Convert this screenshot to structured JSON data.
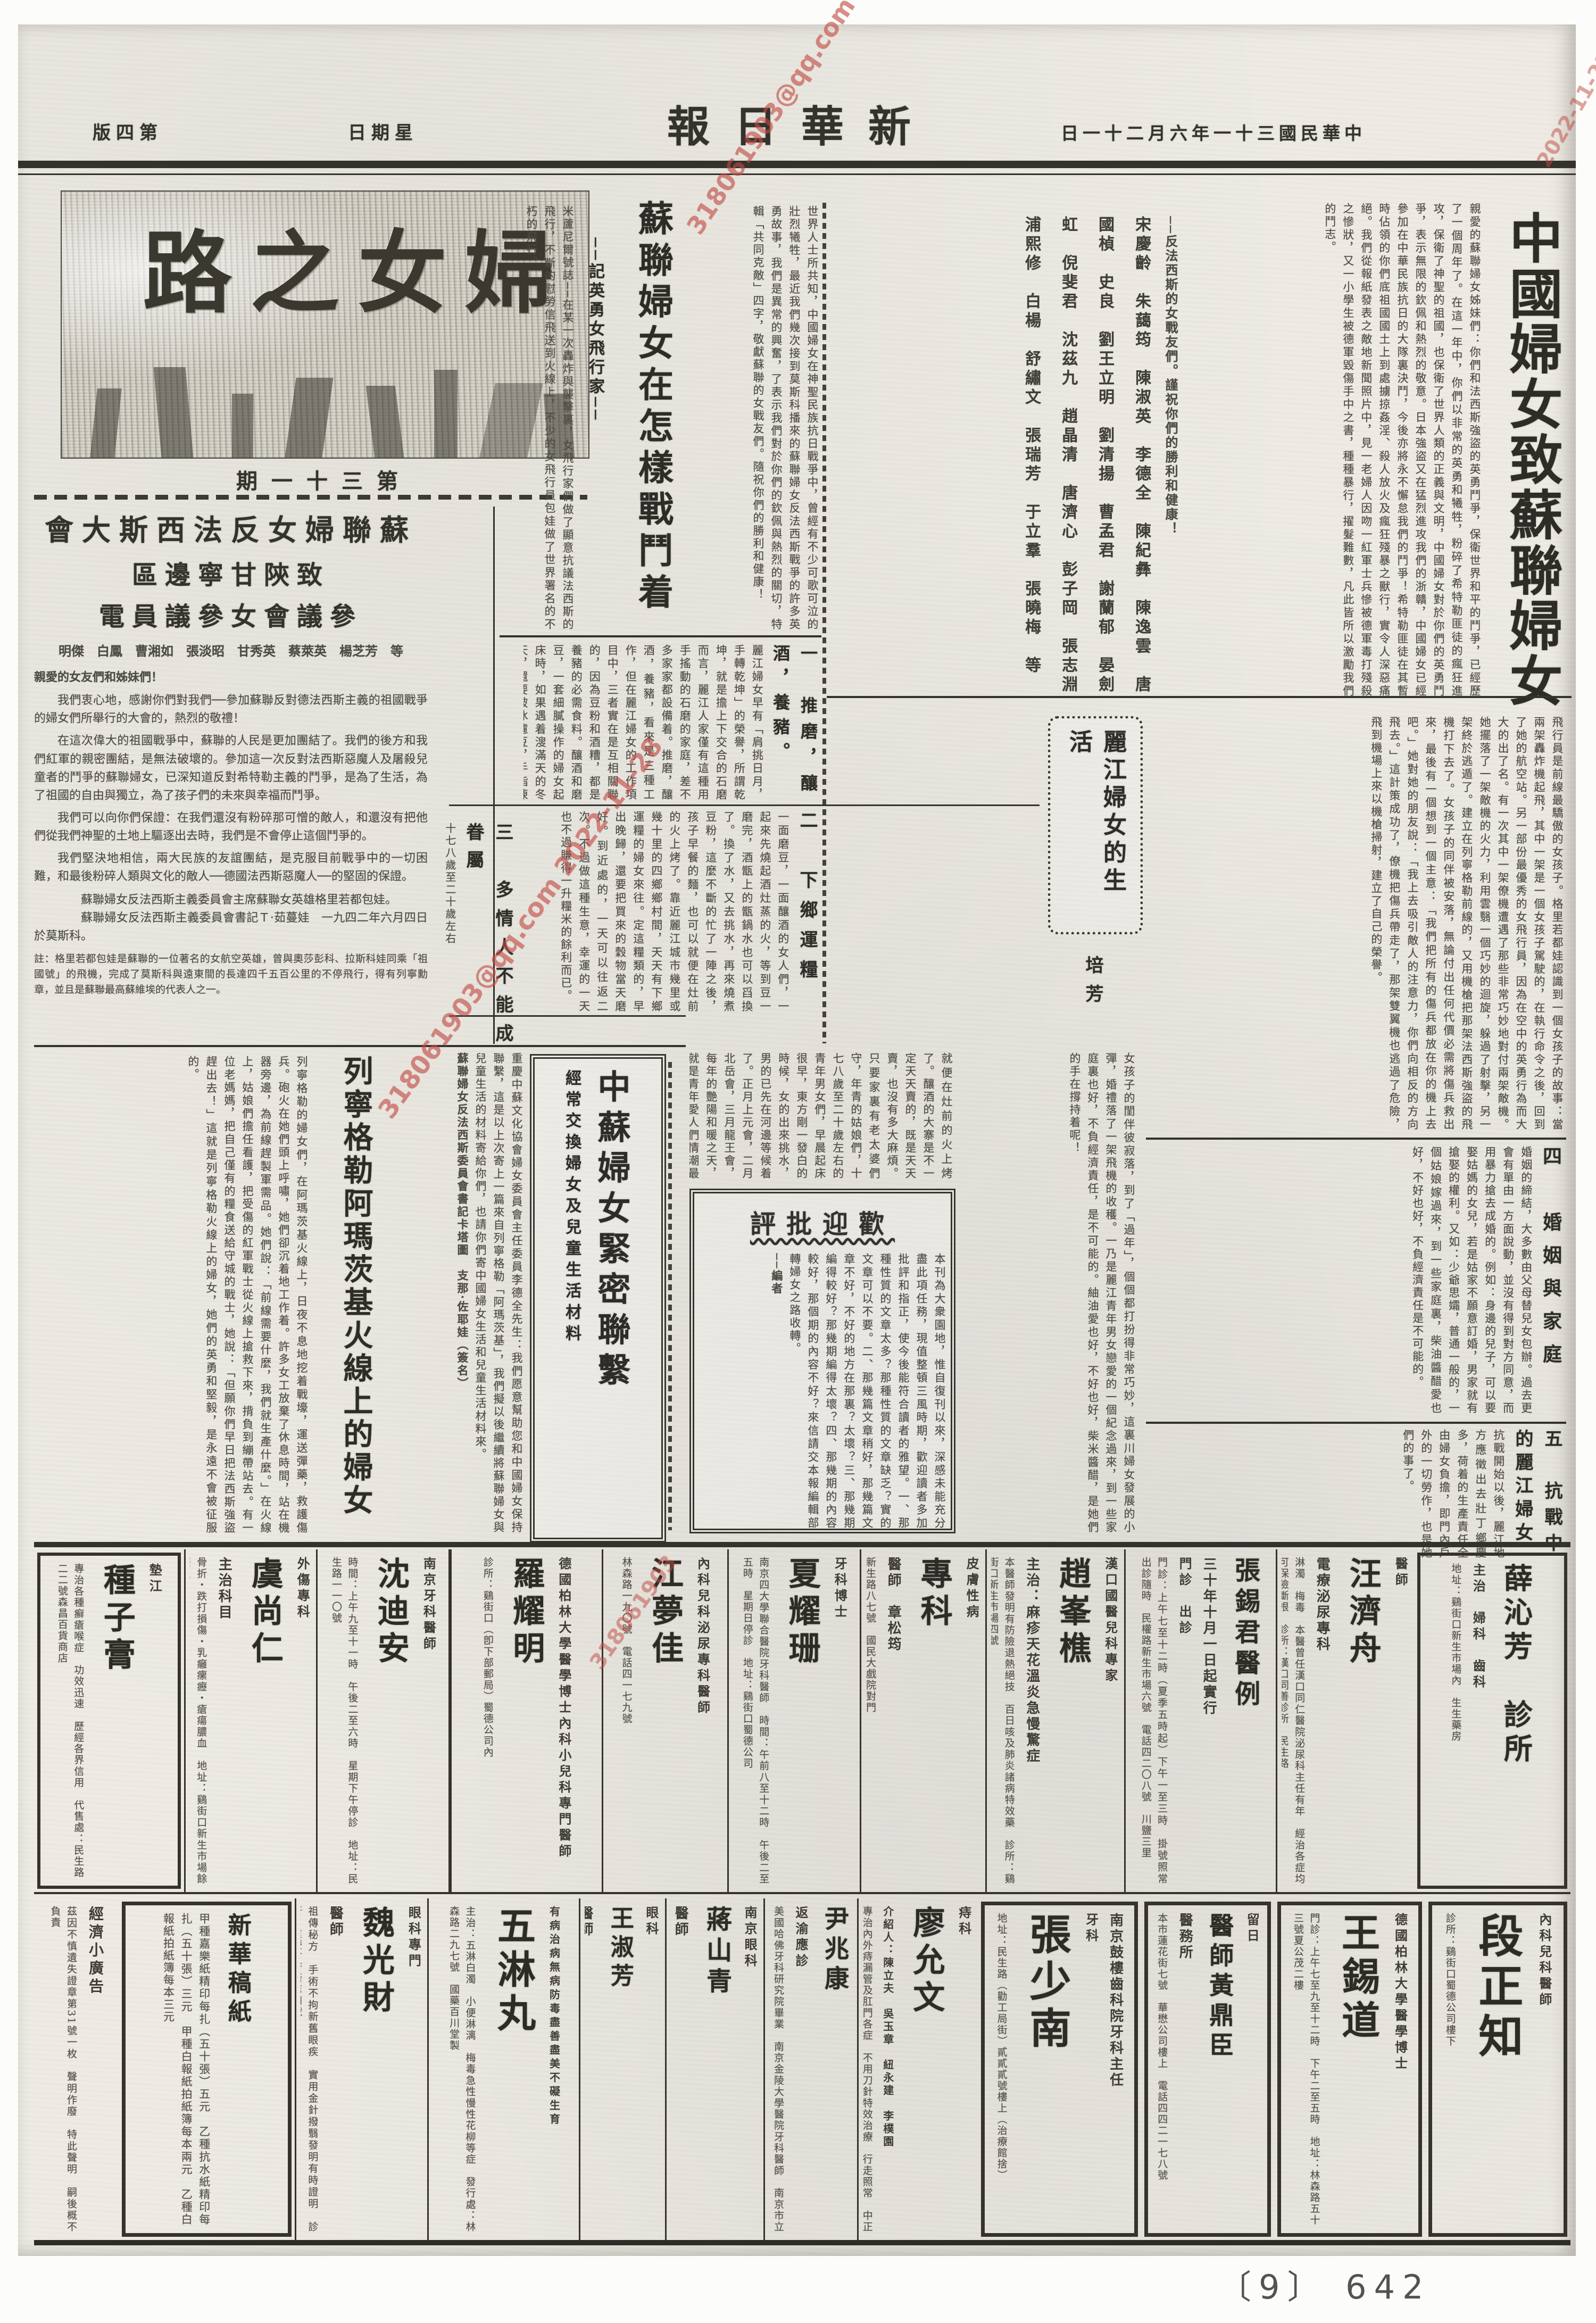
{
  "header": {
    "date": "中華民國三十一年六月二十一日",
    "paper_name": "新華日報",
    "weekday": "星期日",
    "edition": "第四版"
  },
  "masthead": {
    "title": "婦女之路",
    "issue": "第三十一期"
  },
  "watermark": {
    "text": "318061903@qq.com 2022-11-28",
    "short": "318061903",
    "date_only": "2022-11-28",
    "color": "#c24a42"
  },
  "letter_right": {
    "title": "中國婦女致蘇聯婦女書",
    "body": "親愛的蘇聯婦女姊妹們：你們和法西斯強盜的英勇鬥爭，保衛世界和平的鬥爭，已經歷了一個周年了。在這一年中，你們以非常的英勇和犧牲，粉碎了希特勒匪徒的瘋狂進攻，保衛了神聖的祖國，也保衛了世界人類的正義與文明，中國婦女對於你們的英勇鬥爭，表示無限的欽佩和熱烈的敬意。日本強盜又在猛烈進攻我們的浙贛，中國婦女已經參加在中華民族抗日的大隊裏決鬥，今後亦將永不懈怠我們的鬥爭！希特勒匪徒在其暫時佔領的你們底祖國國土上到處擄掠姦淫、殺人放火及瘋狂殘暴之獸行，實令人深惡痛絕。我們從報紙發表之敵地新聞照片中，見一老婦人因吻一紅軍士兵慘被德軍毒打殘殺之慘狀，又一小學生被德軍毀傷手中之書，種種暴行，擢髮難數，凡此皆所以激勵我們的鬥志。",
    "closing": "──反法西斯的女戰友們。謹祝你們的勝利和健康！",
    "signatories": "宋慶齡　朱藹筠　陳淑英　李德全　陳紀彝　陳逸雲　唐國楨　史良　劉王立明　劉清揚　曹孟君　謝蘭郁　晏劍虹　倪斐君　沈茲九　趙晶清　唐濟心　彭子岡　張志淵　浦熙修　白楊　舒繡文　張瑞芳　于立羣　張曉梅　等"
  },
  "aviator": {
    "title": "蘇聯婦女在怎樣戰鬥着",
    "subtitle": "──記英勇女飛行家──",
    "body_right": "世界人士所共知，中國婦女在神聖民族抗日戰爭中，曾經有不少可歌可泣的壯烈犧牲，最近我們幾次接到莫斯科播來的蘇聯婦女反法西斯戰爭的許多英勇故事，我們是異常的興奮，了表示我們對於你們的欽佩與熱烈的關切，特輯「共同克敵」四字，敬獻蘇聯的女戰友們。隨祝你們的勝利和健康！",
    "body_left": "米蘆尼爾號誌──在某一次轟炸與襲擊裏，女飛行家們做了顯意抗議法西斯的飛行，不斷的慰勞信飛送到火線上，不少的女飛行員包娃做了世界署名的不朽的飛行。",
    "continuation": "飛行員是前線最驕傲的女孩子。格里若都娃認識到一個女孩子的故事：當兩架轟炸機起飛，其中一架是一個女孩子駕駛的，在執行命令之後，回到了她的航空站。另一部份最優秀的女飛行員，因為在空中的英勇行為而大大的出了名。有一次其中一架僚機遭遇了那些非常巧妙地對付兩架敵機。她擺落了一架敵機的火力，利用雲翳一個巧妙的迴旋，躲過了射擊，另一架終於逃遁了。建立在列寧格勒前線的，又用機槍把那架法西斯強盜的飛機打下去了。女孩子的同伴被安落，無論付出任何代價必需將傷兵救出來，最後有一個想到一個主意：「我們把所有的傷兵都放在你的機上去吧。」她對她的朋友說：「我上去吸引敵人的注意力，你們向相反的方向飛去。」這計策成功了，僚機把傷兵帶走了，那架雙翼機也逃過了危險，飛到機場上來以機槍掃射，建立了自己的榮譽。"
  },
  "telegram": {
    "headline1": "蘇聯婦女反法西斯大會",
    "headline2": "致陝甘寧邊區",
    "headline3": "參議會女參議員電",
    "names": "明傑　白鳳　曹湘如　張淡昭　甘秀英　蔡萊英　楊芝芳　等",
    "salutation": "親愛的女友們和姊妹們！",
    "p1": "我們衷心地，感謝你們對我們──參加蘇聯反對德法西斯主義的祖國戰爭的婦女們所舉行的大會的，熱烈的敬禮！",
    "p2": "在這次偉大的祖國戰爭中，蘇聯的人民是更加團結了。我們的後方和我們紅軍的親密團結，是無法破壞的。參加這一次反對法西斯惡魔人及屠殺兒童者的鬥爭的蘇聯婦女，已深知道反對希特勒主義的鬥爭，是為了生活，為了祖國的自由與獨立，為了孩子們的未來與幸福而鬥爭。",
    "p3": "我們可以向你們保證：在我們還沒有粉碎那可憎的敵人，和還沒有把他們從我們神聖的土地上驅逐出去時，我們是不會停止這個鬥爭的。",
    "p4": "我們堅決地相信，兩大民族的友誼團結，是克服目前戰爭中的一切困難，和最後粉碎人類與文化的敵人──德國法西斯惡魔人──的堅固的保證。",
    "sig1": "蘇聯婦女反法西斯主義委員會主席蘇聯女英雄格里若都包娃。",
    "sig2": "蘇聯婦女反法西斯主義委員會書記Ｔ·茹蔓娃　一九四二年六月四日於莫斯科。",
    "note": "註：格里若都包娃是蘇聯的一位著名的女航空英雄，曾與奧莎彭科、拉斯科娃同乘「祖國號」的飛機，完成了莫斯科與遠東間的長達四千五百公里的不停飛行，得有列寧勳章，並且是蘇聯最高蘇維埃的代表人之一。"
  },
  "lijiang": {
    "title": "麗江婦女的生活",
    "author": "培芳",
    "s1_head": "一　推磨，釀酒，養豬。",
    "intro_s1": "麗江婦女早有「肩挑日月，手轉乾坤」的榮譽，所謂乾坤，就是擔上下交合的石磨而言，麗江人家僅有這種用手搖動的石磨的家庭，差不多家家都設備着。推磨，釀酒，養豬，看來是三種工作，但在麗江婦女的工作項目中，三者實在是互相關聯的，因為豆粉和酒糟，都是養豬的必需食料。釀酒和磨豆，一套細膩操作的婦女起床時，如果遇着溲滿天的冬天，還要破冰濾豆，手指凍僵，高捲着袖子搶起磨來，渾身冷得發抖，風飄入胸間，然而用力推磨，汗珠反會循着鬢邊流了出來。",
    "s2_head": "二　下鄉運糧",
    "s2": "一面磨豆，一面釀酒的女人們，一起來先燒起酒灶蒸的火，等到豆一磨完，酒甑上的甑鍋水也可以舀換了。換了水，又去挑水，再來燒煮豆粉，這麼不斷的忙了一陣之後，孩子早餐的麵，也可以就便在灶前的火上烤了。靠近麗江城市幾里或幾十里的四鄉鄉村間，天天有下鄉運糧的婦女來往。定這糧類的，早出晚歸，還要把買來的穀物當天磨好。到近處的，一天可以往返二次。不過做這種生意，幸運的一天也不過賺得一升糧米的餘利而已。",
    "s3_head": "三　多情人不能成眷屬",
    "s3_side": "十七八歲至二十歲左右",
    "s3": "就便在灶前的火上烤了。釀酒的大寨是不一定天天賣的，既是天天賣，也沒有多大麻煩。只要家裏有老太婆們守，年青的姑娘們，十七八歲至二十歲左右的青年男女們，早晨起床很早，東方剛一發白的時候，女的出來挑水，男的已先在河邊等候着了。正月上元會，二月北岳會，三月龍王會，每年的艷陽和暖之天，就是青年愛人們情潮最高漲的季節。未婚妻發見了未婚夫，只好裝作不相識，要是未婚夫遇到未婚妻於途中時，那種秘情默會時的感情上留了烙印，大都在未來的婚姻裏釀成了一個多情人不能成眷屬的悲劇，因而發生殉情的風潮。",
    "s4_head": "四　婚姻與家庭",
    "s4": "婚姻的締結，大多數由父母替兒女包辦。過去更會有單由一方面說動，並沒有得到對方同意，而用暴力搶去成婚的。例如：身邊的兒子，可以要娶姑媽的女兒，若是姑家不願意訂婚，男家就有搶娶的權利。又如：少爺思孀，普通一般的，一個姑娘嫁過來，到一些家庭裏，柴油醬醋愛也好，不好也好，不負經濟責任是不可能的。",
    "s5_head": "五　抗戰中的麗江婦女",
    "s5": "抗戰開始以後，麗江地方應徵出去壯丁鄉慶多，荷着的生產責任全由婦女負擔，即門內戶外的一切勞作，也是她們的事了。",
    "mid": "女孩子的閨伴彼寂落，到了「過年」，個個都打扮得非常巧妙，這裏川婦女發展的小彈，婚禮落了一架飛機的收穫。一乃是麗江青年男女戀愛的一個紀念過來，到一些家庭裏也好，不負經濟責任，是不可能的。紬油愛也好，不好也好，柴米醬醋，是她們的手在撐持着呢！"
  },
  "exchange_box": {
    "title": "中蘇婦女緊密聯繫",
    "subtitle": "經常交換婦女及兒童生活材料"
  },
  "leningrad": {
    "title": "列寧格勒阿瑪茨基火線上的婦女",
    "intro": "重慶中蘇文化協會婦女委員會主任委員李德全先生：我們愿意幫助您和中國婦女保持聯繫，這是以上次寄上一篇來自列寧格勒「阿瑪茨基」，我們擬以後繼續將蘇聯婦女與兒童生活的材料寄給你們，也請你們寄中國婦女生活和兒童生活材料來。",
    "sig": "蘇聯婦女反法西斯委員會書記卡塔圖　支那·佐耶娃（簽名）",
    "body": "列寧格勒的婦女們，在阿瑪茨基火線上，日夜不息地挖着戰壕，運送彈藥，救護傷兵。砲火在她們頭上呼嘯，她們卻沉着地工作着。許多女工放棄了休息時間，站在機器旁邊，為前線趕製軍需品。她們說：「前線需要什麼，我們就生產什麼。」在火線上，姑娘們擔任看護，把受傷的紅軍戰士從火線上搶救下來，揹負到繃帶站去。有一位老媽媽，把自己僅有的糧食送給守城的戰士，她說：「但願你們早日把法西斯強盜趕出去！」這就是列寧格勒火線上的婦女，她們的英勇和堅毅，是永遠不會被征服的。"
  },
  "critique_box": {
    "title": "歡迎批評",
    "body": "本刊為大衆園地，惟自復刊以來，深感未能充分盡此項任務，現值整頓三風時期，歡迎讀者多加批評和指正，使今後能符合讀者的雅望。一、那種性質的文章太多？那種性質的文章缺乏？實的文章可以不要。二、那幾篇文章稍好，那幾篇文章不好，不好的地方在那裏？太壞？三、那幾期編得較好？那幾期編得太壞？四、那幾期的內容較好，那個期的內容不好？來信請交本報編輯部轉婦女之路收轉。",
    "signoff": "──編者"
  },
  "ads_row1": [
    {
      "kicker": "墊江",
      "big": "種子膏",
      "sub": "",
      "small": "專治各種癬瘡喉症　功效迅速　歷經各界信用　代售處：民生路二二號森昌百貨商店"
    },
    {
      "kicker": "外傷專科",
      "big": "虞尚仁",
      "sub": "主治科目",
      "small": "骨折・跌打損傷・乳癰瘰癧・瘡瘍膿血　地址：鷄街口新生市場餘慶里"
    },
    {
      "kicker": "南京牙科醫師",
      "big": "沈迪安",
      "sub": "",
      "small": "時間：上午九至十一時　午後二至六時　星期下午停診　地址：民生路一一〇號"
    },
    {
      "kicker": "德國柏林大學醫學博士內科小兒科專門醫師",
      "big": "羅耀明",
      "sub": "",
      "small": "診所：鷄街口（卽下部郵局）蜀德公司內"
    },
    {
      "kicker": "內科兒科泌尿專科醫師",
      "big": "江夢佳",
      "sub": "",
      "small": "林森路一九〇號　電話四一七九號"
    },
    {
      "kicker": "牙科博士",
      "big": "夏耀珊",
      "sub": "",
      "small": "南京四大學聯合醫院牙科醫師　時間：午前八至十二時　午後二至五時　星期日停診　地址：鷄街口蜀德公司"
    },
    {
      "kicker": "皮膚性病",
      "big": "專科",
      "sub": "醫師　章松筠",
      "small": "新生路八七號　國民大戲院對門"
    },
    {
      "kicker": "漢口國醫兒科專家",
      "big": "趙峯樵",
      "sub": "主治：麻疹天花溫炎急慢驚症",
      "small": "本醫師發明有防險退熱絕技　百日咳及肺炎諸病特效藥　診所：鷄街口新生市場四號"
    },
    {
      "kicker": "門診　出診",
      "big": "張錫君醫例",
      "sub": "三十年十月一日起實行",
      "small": "門診：上午七至十二時（夏季五時起）下午一至三時　掛號照常　出診隨時　民權路新生市場六號　電話四二〇八號　川鹽三里"
    },
    {
      "kicker": "醫師",
      "big": "汪濟舟",
      "sub": "電療泌尿專科",
      "small": "淋濁　梅毒　本醫曾任漢口同仁醫院泌尿科主任有年　經治各症均可保險斷根　診所：漢口同善診所　民生路"
    },
    {
      "kicker": "主治　婦科　齒科",
      "big": "薛沁芳　診所",
      "sub": "",
      "small": "地址：鷄街口新生市場內　生生藥房"
    }
  ],
  "ads_row2": [
    {
      "kicker": "",
      "big": "經濟小廣告",
      "sub": "",
      "small": "茲因不慎遺失證章第31號一枚　聲明作廢　特此聲明　嗣後概不負責"
    },
    {
      "kicker": "",
      "big": "新華稿紙",
      "sub": "",
      "small": "甲種嘉樂紙精印每扎（五十張）五元　乙種抗水紙精印每扎（五十張）三元　甲種白報紙拍紙簿每本兩元　乙種白報紙拍紙簿每本三元"
    },
    {
      "kicker": "眼科專門",
      "big": "魏光財",
      "sub": "醫師",
      "small": "祖傳秘方　手術不拘新舊眼疾　實用金針撥翳發明有時證明　診所：重慶會府衙第四號"
    },
    {
      "kicker": "有病治病無病防毒盡善盡美不礙生育",
      "big": "五淋丸",
      "sub": "",
      "small": "主治：五淋白濁　小便淋漓　梅毒急性慢性花柳等症　發行處：林森路二九七號　國藥百川堂製"
    },
    {
      "kicker": "眼科",
      "big": "王淑芳",
      "sub": "醫師",
      "small": "專門　中一路一〇四號　全日應診"
    },
    {
      "kicker": "南京眼科",
      "big": "蔣山青",
      "sub": "醫師",
      "small": "中一路四德里十五號　樓上　今日應診"
    },
    {
      "kicker": "返渝應診",
      "big": "尹兆康",
      "sub": "",
      "small": "美國哈佛牙科研究院畢業　南京金陵大學醫院牙科醫師　南京市立醫院牙科主任　時間：九至十一時　二至四時　星期日休診　民生路二二九號樓上"
    },
    {
      "kicker": "痔科",
      "big": "廖允文",
      "sub": "介紹人：陳立夫　吳玉章　紐永建　李樸園",
      "small": "專治內外痔漏管及肛門各症　不用刀針特效治療　行走照常　中正路六一九號　治癒銘謝"
    },
    {
      "kicker": "牙科",
      "big": "張少南",
      "sub": "南京鼓樓齒科院牙科主任",
      "small": "地址：民生路（勸工局街）貳貳貳號樓上（治療館捨）"
    },
    {
      "kicker": "留日",
      "big": "醫師黃鼎臣",
      "sub": "醫務所",
      "small": "本市蓮花街七號　華懋公司樓上　電話四四二一七八號"
    },
    {
      "kicker": "德國柏林大學醫學博士",
      "big": "王錫道",
      "sub": "",
      "small": "門診：上午七至九至十二時　下午二至五時　地址：林森路五十三號夏公茂二樓"
    },
    {
      "kicker": "內科兒科醫師",
      "big": "段正知",
      "sub": "",
      "small": "診所：鷄街口蜀德公司樓下"
    }
  ],
  "footer": {
    "page_number": "〔9〕 642"
  }
}
